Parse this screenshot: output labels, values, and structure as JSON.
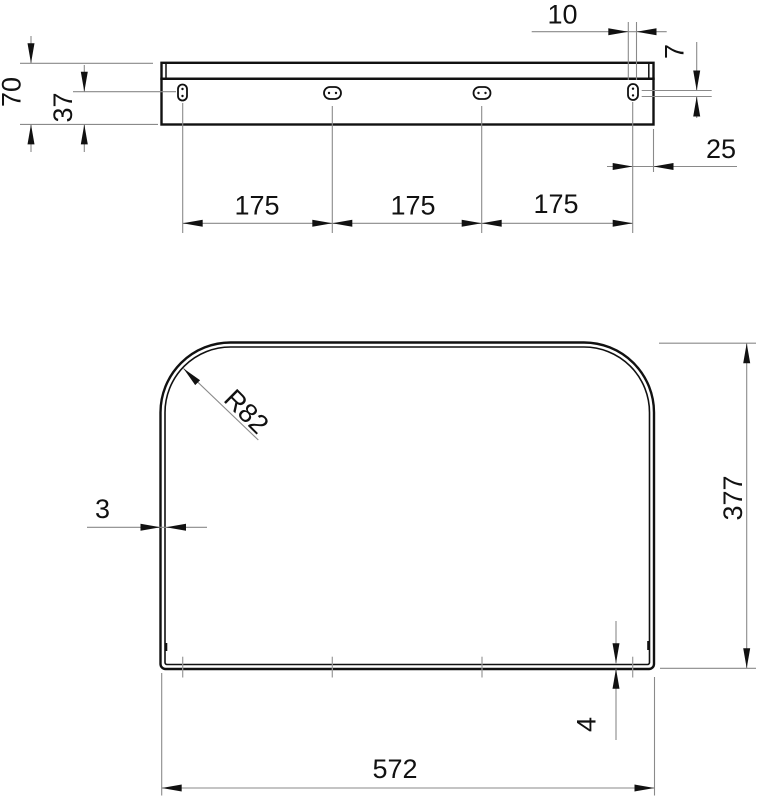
{
  "drawing": {
    "type": "technical-dimension-drawing",
    "views": [
      "side-profile-view",
      "plan-view"
    ],
    "units_shown": false
  },
  "colors": {
    "background": "#ffffff",
    "part_outline": "#111111",
    "dimension_line": "#8a8a8a",
    "text": "#111111"
  },
  "dims": {
    "d70": "70",
    "d37": "37",
    "d10": "10",
    "d7": "7",
    "d25": "25",
    "d175_1": "175",
    "d175_2": "175",
    "d175_3": "175",
    "r82": "R82",
    "d3": "3",
    "d377": "377",
    "d4": "4",
    "d572": "572"
  }
}
